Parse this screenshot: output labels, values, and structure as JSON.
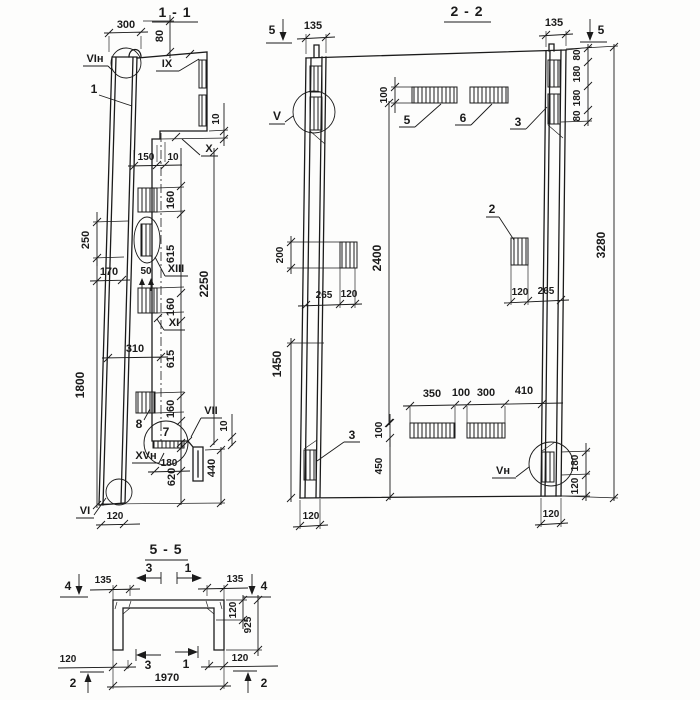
{
  "s11": {
    "title": "1 - 1",
    "parts": {
      "p1": "1",
      "p7": "7",
      "p8": "8"
    },
    "markers": {
      "vin": "VIн",
      "ix": "IX",
      "x": "X",
      "xiii": "XIII",
      "xi": "XI",
      "vii": "VII",
      "xvn": "XVн",
      "vi": "VI"
    },
    "dims": {
      "d300": "300",
      "d80": "80",
      "d10a": "10",
      "d150": "150",
      "d10b": "10",
      "d160a": "160",
      "d615a": "615",
      "d160b": "160",
      "d615b": "615",
      "d160c": "160",
      "d2250": "2250",
      "d50": "50",
      "d310": "310",
      "d170": "170",
      "d250": "250",
      "d1800": "1800",
      "d10c": "10",
      "d180": "180",
      "d620": "620",
      "d440": "440",
      "d120": "120"
    }
  },
  "s22": {
    "title": "2 - 2",
    "parts": {
      "p2": "2",
      "p3a": "3",
      "p3b": "3",
      "p5": "5",
      "p6": "6"
    },
    "markers": {
      "v": "V",
      "vn": "Vн",
      "cut5l": "5",
      "cut5r": "5"
    },
    "dims": {
      "d135l": "135",
      "d135r": "135",
      "d100t": "100",
      "d80a": "80",
      "d180a": "180",
      "d180b": "180",
      "d80b": "80",
      "d3280": "3280",
      "d2400": "2400",
      "d200": "200",
      "d265l": "265",
      "d120a": "120",
      "d120b": "120",
      "d265r": "265",
      "d1450": "1450",
      "d350": "350",
      "d100m": "100",
      "d300": "300",
      "d410": "410",
      "d100b": "100",
      "d450": "450",
      "d180c": "180",
      "d120c": "120",
      "d120d": "120",
      "d120e": "120"
    }
  },
  "s55": {
    "title": "5 - 5",
    "markers": {
      "c4l": "4",
      "c4r": "4",
      "c3t": "3",
      "c1t": "1",
      "c3b": "3",
      "c1b": "1",
      "c2l": "2",
      "c2r": "2"
    },
    "dims": {
      "d135l": "135",
      "d135r": "135",
      "d120a": "120",
      "d925": "925",
      "d120b": "120",
      "d120c": "120",
      "d1970": "1970"
    }
  }
}
